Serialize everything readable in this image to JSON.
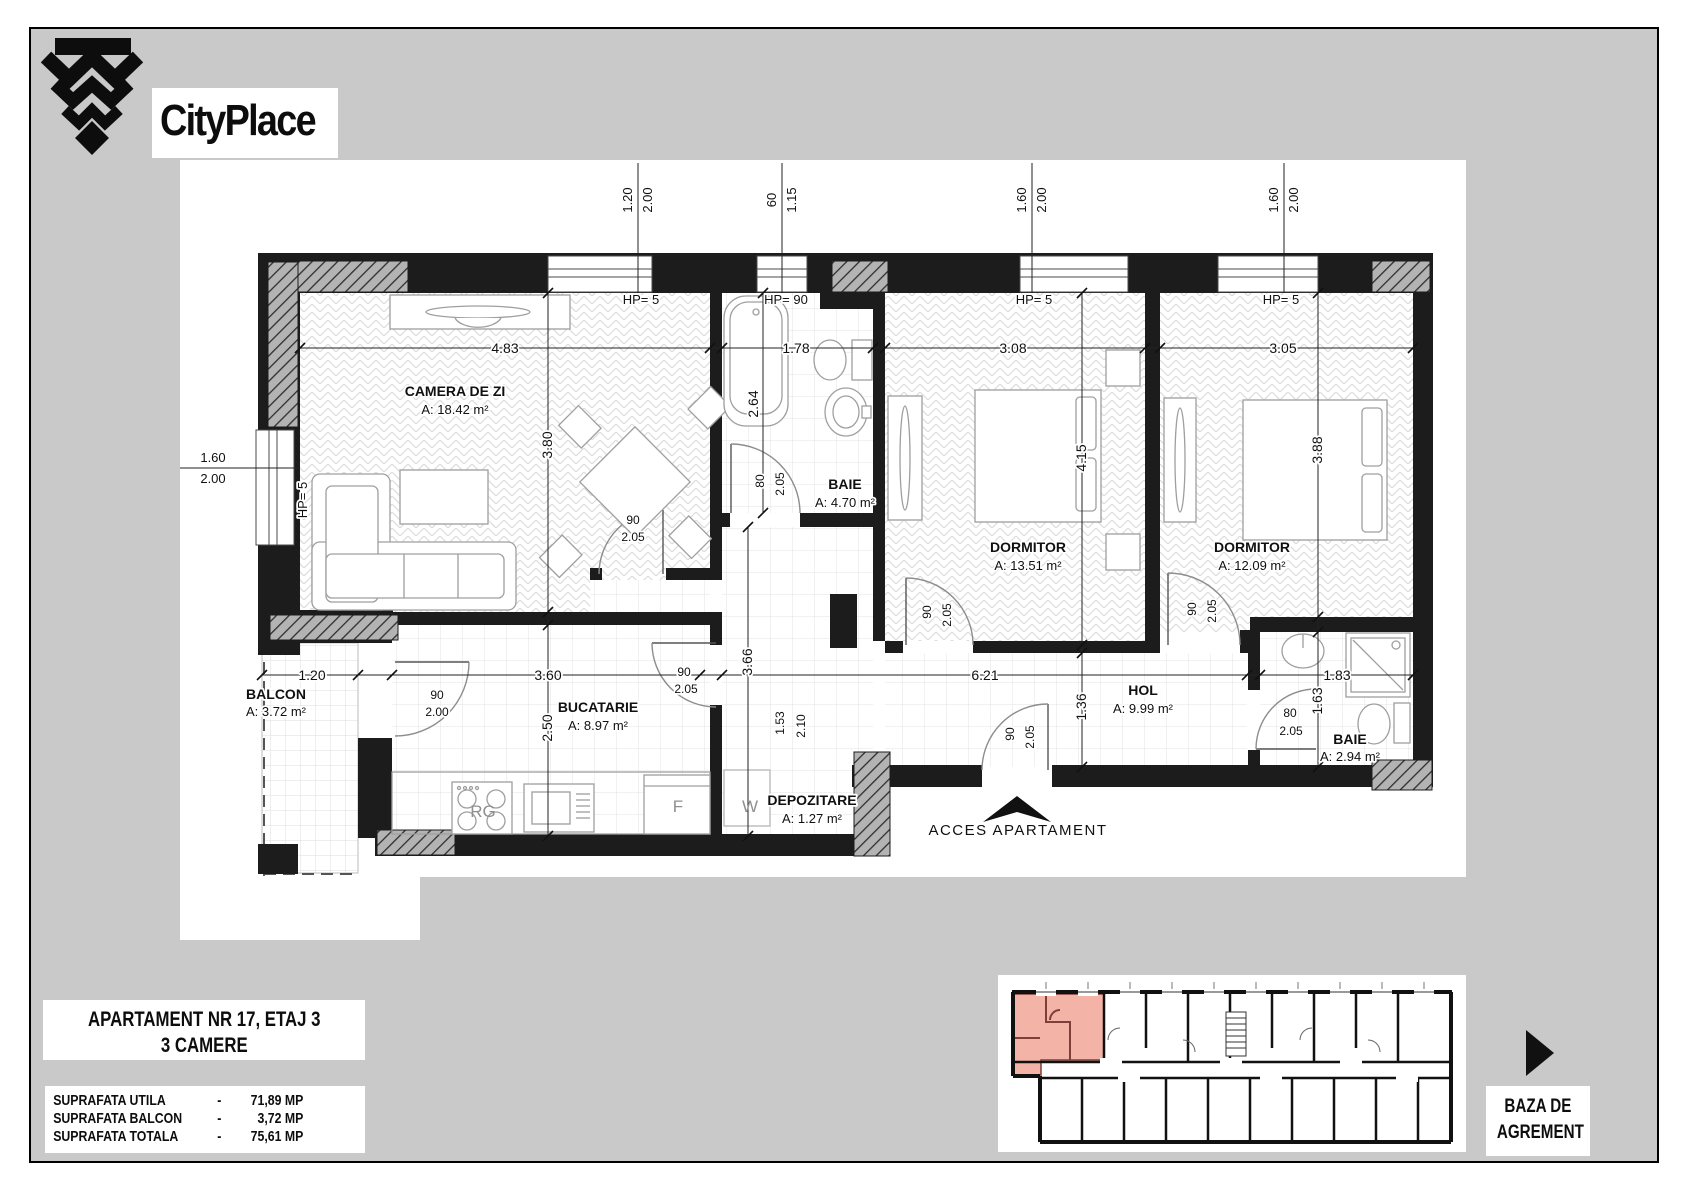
{
  "branding": {
    "name": "CityPlace"
  },
  "title_block": {
    "line1": "APARTAMENT NR 17, ETAJ 3",
    "line2": "3 CAMERE"
  },
  "surface_table": {
    "rows": [
      {
        "label": "SUPRAFATA UTILA",
        "dash": "-",
        "value": "71,89 MP"
      },
      {
        "label": "SUPRAFATA BALCON",
        "dash": "-",
        "value": "3,72 MP"
      },
      {
        "label": "SUPRAFATA TOTALA",
        "dash": "-",
        "value": "75,61 MP"
      }
    ]
  },
  "baza": {
    "line1": "BAZA DE",
    "line2": "AGREMENT"
  },
  "plan": {
    "rooms": [
      {
        "name": "CAMERA DE ZI",
        "area_m2": "18.42"
      },
      {
        "name": "BAIE",
        "area_m2": "4.70"
      },
      {
        "name": "DORMITOR",
        "area_m2": "13.51"
      },
      {
        "name": "DORMITOR",
        "area_m2": "12.09"
      },
      {
        "name": "BALCON",
        "area_m2": "3.72"
      },
      {
        "name": "BUCATARIE",
        "area_m2": "8.97"
      },
      {
        "name": "HOL",
        "area_m2": "9.99"
      },
      {
        "name": "DEPOZITARE",
        "area_m2": "1.27"
      },
      {
        "name": "BAIE",
        "area_m2": "2.94"
      }
    ],
    "labels": [
      {
        "t": "CAMERA DE ZI",
        "x": 455,
        "y": 396,
        "c": "room"
      },
      {
        "t": "A: 18.42 m²",
        "x": 455,
        "y": 414,
        "c": "area"
      },
      {
        "t": "BAIE",
        "x": 845,
        "y": 489,
        "c": "room"
      },
      {
        "t": "A: 4.70 m²",
        "x": 845,
        "y": 507,
        "c": "area"
      },
      {
        "t": "DORMITOR",
        "x": 1028,
        "y": 552,
        "c": "room"
      },
      {
        "t": "A: 13.51 m²",
        "x": 1028,
        "y": 570,
        "c": "area"
      },
      {
        "t": "DORMITOR",
        "x": 1252,
        "y": 552,
        "c": "room"
      },
      {
        "t": "A: 12.09 m²",
        "x": 1252,
        "y": 570,
        "c": "area"
      },
      {
        "t": "BALCON",
        "x": 276,
        "y": 699,
        "c": "room",
        "a": "start"
      },
      {
        "t": "A: 3.72 m²",
        "x": 276,
        "y": 716,
        "c": "area",
        "a": "start"
      },
      {
        "t": "BUCATARIE",
        "x": 598,
        "y": 712,
        "c": "room"
      },
      {
        "t": "A: 8.97 m²",
        "x": 598,
        "y": 730,
        "c": "area"
      },
      {
        "t": "HOL",
        "x": 1143,
        "y": 695,
        "c": "room"
      },
      {
        "t": "A: 9.99 m²",
        "x": 1143,
        "y": 713,
        "c": "area"
      },
      {
        "t": "DEPOZITARE",
        "x": 812,
        "y": 805,
        "c": "room"
      },
      {
        "t": "A: 1.27 m²",
        "x": 812,
        "y": 823,
        "c": "area"
      },
      {
        "t": "BAIE",
        "x": 1350,
        "y": 744,
        "c": "room"
      },
      {
        "t": "A: 2.94 m²",
        "x": 1350,
        "y": 761,
        "c": "area"
      },
      {
        "t": "4.83",
        "x": 505,
        "y": 353,
        "c": "dim"
      },
      {
        "t": "1.78",
        "x": 796,
        "y": 353,
        "c": "dim"
      },
      {
        "t": "3.08",
        "x": 1013,
        "y": 353,
        "c": "dim"
      },
      {
        "t": "3.05",
        "x": 1283,
        "y": 353,
        "c": "dim"
      },
      {
        "t": "1.20",
        "x": 312,
        "y": 680,
        "c": "dim"
      },
      {
        "t": "3.60",
        "x": 548,
        "y": 680,
        "c": "dim"
      },
      {
        "t": "6.21",
        "x": 985,
        "y": 680,
        "c": "dim"
      },
      {
        "t": "1.83",
        "x": 1337,
        "y": 680,
        "c": "dim"
      },
      {
        "t": "3.80",
        "x": 552,
        "y": 445,
        "r": -90,
        "c": "dim"
      },
      {
        "t": "2.64",
        "x": 758,
        "y": 404,
        "r": -90,
        "c": "dim"
      },
      {
        "t": "4.15",
        "x": 1086,
        "y": 458,
        "r": -90,
        "c": "dim"
      },
      {
        "t": "3.88",
        "x": 1322,
        "y": 450,
        "r": -90,
        "c": "dim"
      },
      {
        "t": "2.50",
        "x": 552,
        "y": 728,
        "r": -90,
        "c": "dim"
      },
      {
        "t": "3.66",
        "x": 752,
        "y": 662,
        "r": -90,
        "c": "dim"
      },
      {
        "t": "1.36",
        "x": 1086,
        "y": 707,
        "r": -90,
        "c": "dim"
      },
      {
        "t": "1.63",
        "x": 1322,
        "y": 701,
        "r": -90,
        "c": "dim"
      },
      {
        "t": "1.20",
        "x": 632,
        "y": 200,
        "r": -90,
        "c": "wdim"
      },
      {
        "t": "2.00",
        "x": 652,
        "y": 200,
        "r": -90,
        "c": "wdim"
      },
      {
        "t": "60",
        "x": 776,
        "y": 200,
        "r": -90,
        "c": "wdim"
      },
      {
        "t": "1.15",
        "x": 796,
        "y": 200,
        "r": -90,
        "c": "wdim"
      },
      {
        "t": "1.60",
        "x": 1026,
        "y": 200,
        "r": -90,
        "c": "wdim"
      },
      {
        "t": "2.00",
        "x": 1046,
        "y": 200,
        "r": -90,
        "c": "wdim"
      },
      {
        "t": "1.60",
        "x": 1278,
        "y": 200,
        "r": -90,
        "c": "wdim"
      },
      {
        "t": "2.00",
        "x": 1298,
        "y": 200,
        "r": -90,
        "c": "wdim"
      },
      {
        "t": "1.60",
        "x": 213,
        "y": 462,
        "c": "wdim"
      },
      {
        "t": "2.00",
        "x": 213,
        "y": 483,
        "c": "wdim"
      },
      {
        "t": "HP= 5",
        "x": 641,
        "y": 304,
        "c": "hp"
      },
      {
        "t": "HP= 90",
        "x": 786,
        "y": 304,
        "c": "hp"
      },
      {
        "t": "HP= 5",
        "x": 1034,
        "y": 304,
        "c": "hp"
      },
      {
        "t": "HP= 5",
        "x": 1281,
        "y": 304,
        "c": "hp"
      },
      {
        "t": "HP= 5",
        "x": 307,
        "y": 500,
        "r": -90,
        "c": "hp"
      },
      {
        "t": "90",
        "x": 633,
        "y": 524,
        "c": "door"
      },
      {
        "t": "2.05",
        "x": 633,
        "y": 541,
        "c": "door"
      },
      {
        "t": "90",
        "x": 684,
        "y": 676,
        "c": "door"
      },
      {
        "t": "2.05",
        "x": 686,
        "y": 693,
        "c": "door"
      },
      {
        "t": "90",
        "x": 437,
        "y": 699,
        "c": "door"
      },
      {
        "t": "2.00",
        "x": 437,
        "y": 716,
        "c": "door"
      },
      {
        "t": "80",
        "x": 764,
        "y": 481,
        "r": -90,
        "c": "door"
      },
      {
        "t": "2.05",
        "x": 784,
        "y": 484,
        "r": -90,
        "c": "door"
      },
      {
        "t": "90",
        "x": 931,
        "y": 612,
        "r": -90,
        "c": "door"
      },
      {
        "t": "2.05",
        "x": 951,
        "y": 615,
        "r": -90,
        "c": "door"
      },
      {
        "t": "90",
        "x": 1196,
        "y": 609,
        "r": -90,
        "c": "door"
      },
      {
        "t": "2.05",
        "x": 1216,
        "y": 611,
        "r": -90,
        "c": "door"
      },
      {
        "t": "80",
        "x": 1290,
        "y": 717,
        "c": "door"
      },
      {
        "t": "2.05",
        "x": 1291,
        "y": 735,
        "c": "door"
      },
      {
        "t": "90",
        "x": 1014,
        "y": 734,
        "r": -90,
        "c": "door"
      },
      {
        "t": "2.05",
        "x": 1034,
        "y": 737,
        "r": -90,
        "c": "door"
      },
      {
        "t": "1.53",
        "x": 784,
        "y": 723,
        "r": -90,
        "c": "door"
      },
      {
        "t": "2.10",
        "x": 805,
        "y": 726,
        "r": -90,
        "c": "door"
      },
      {
        "t": "RG",
        "x": 483,
        "y": 817,
        "c": "app"
      },
      {
        "t": "F",
        "x": 678,
        "y": 812,
        "c": "app"
      },
      {
        "t": "W",
        "x": 750,
        "y": 812,
        "c": "app"
      },
      {
        "t": "ACCES APARTAMENT",
        "x": 1018,
        "y": 835,
        "c": "access"
      }
    ]
  },
  "colors": {
    "background_gray": "#c9c9c9",
    "wall_black": "#1c1c1c",
    "hatch_gray": "#b3b3b3",
    "highlight_apartment_pink": "#f4b3a7",
    "paper_white": "#ffffff"
  }
}
